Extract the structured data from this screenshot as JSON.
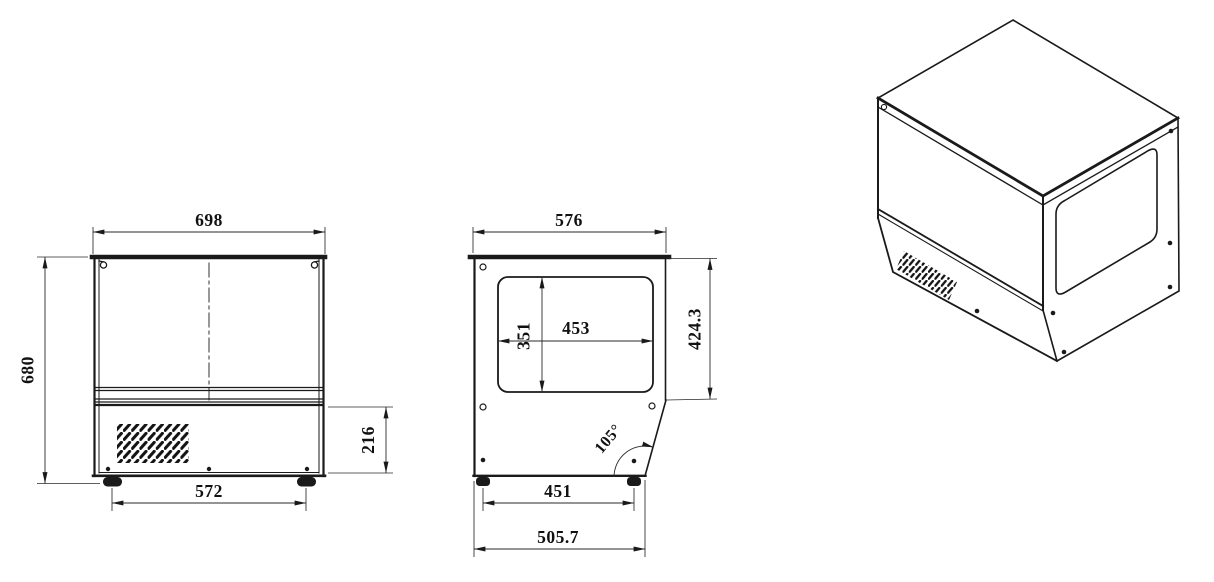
{
  "meta": {
    "background_color": "#ffffff",
    "line_color": "#1a1a1a"
  },
  "views": {
    "front": {
      "width": "698",
      "height": "680",
      "base_height": "216",
      "feet_span": "572"
    },
    "side": {
      "depth": "576",
      "window_width": "453",
      "window_height": "351",
      "body_height": "424.3",
      "front_angle": "105°",
      "feet_span": "451",
      "base_depth": "505.7"
    }
  }
}
